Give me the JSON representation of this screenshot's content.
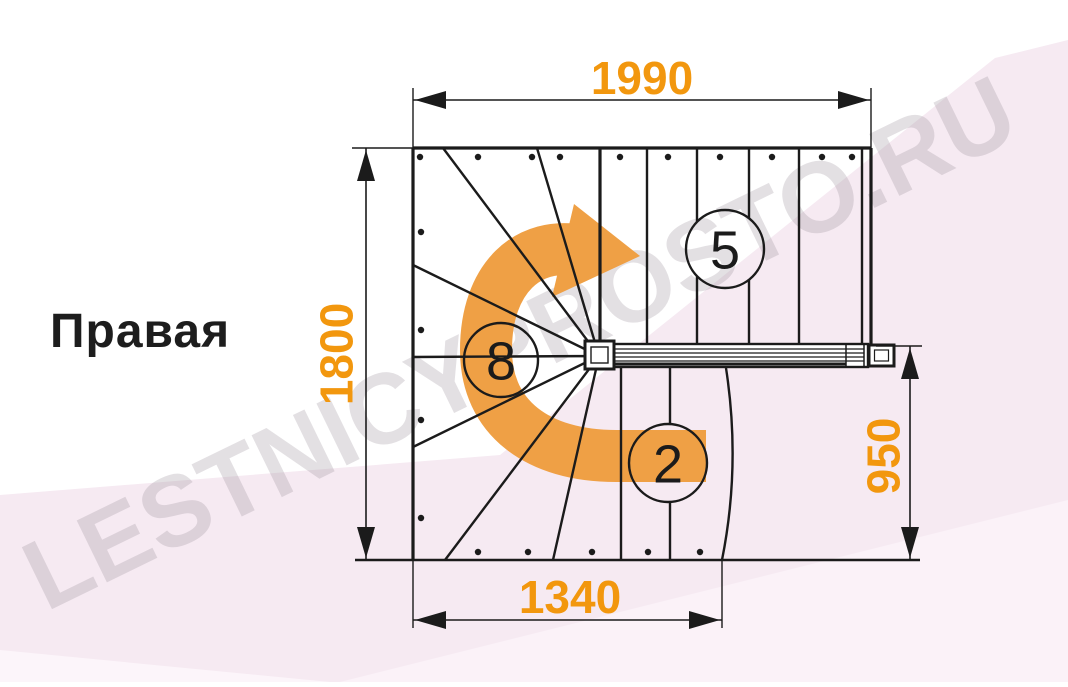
{
  "title": "Правая",
  "watermark": "LESTNICYPROSTO.RU",
  "dimensions": {
    "top": "1990",
    "left": "1800",
    "right": "950",
    "bottom": "1340"
  },
  "step_counts": {
    "upper_flight": "5",
    "winder": "8",
    "lower_flight": "2"
  },
  "colors": {
    "dimension_text": "#F2970E",
    "rotation_arrow": "#EFA045",
    "drawing_line": "#1B1B1B",
    "background_band": "#F6EAF2",
    "background_band_light": "#FBF2F8",
    "watermark_text": "#9B8F9B"
  }
}
